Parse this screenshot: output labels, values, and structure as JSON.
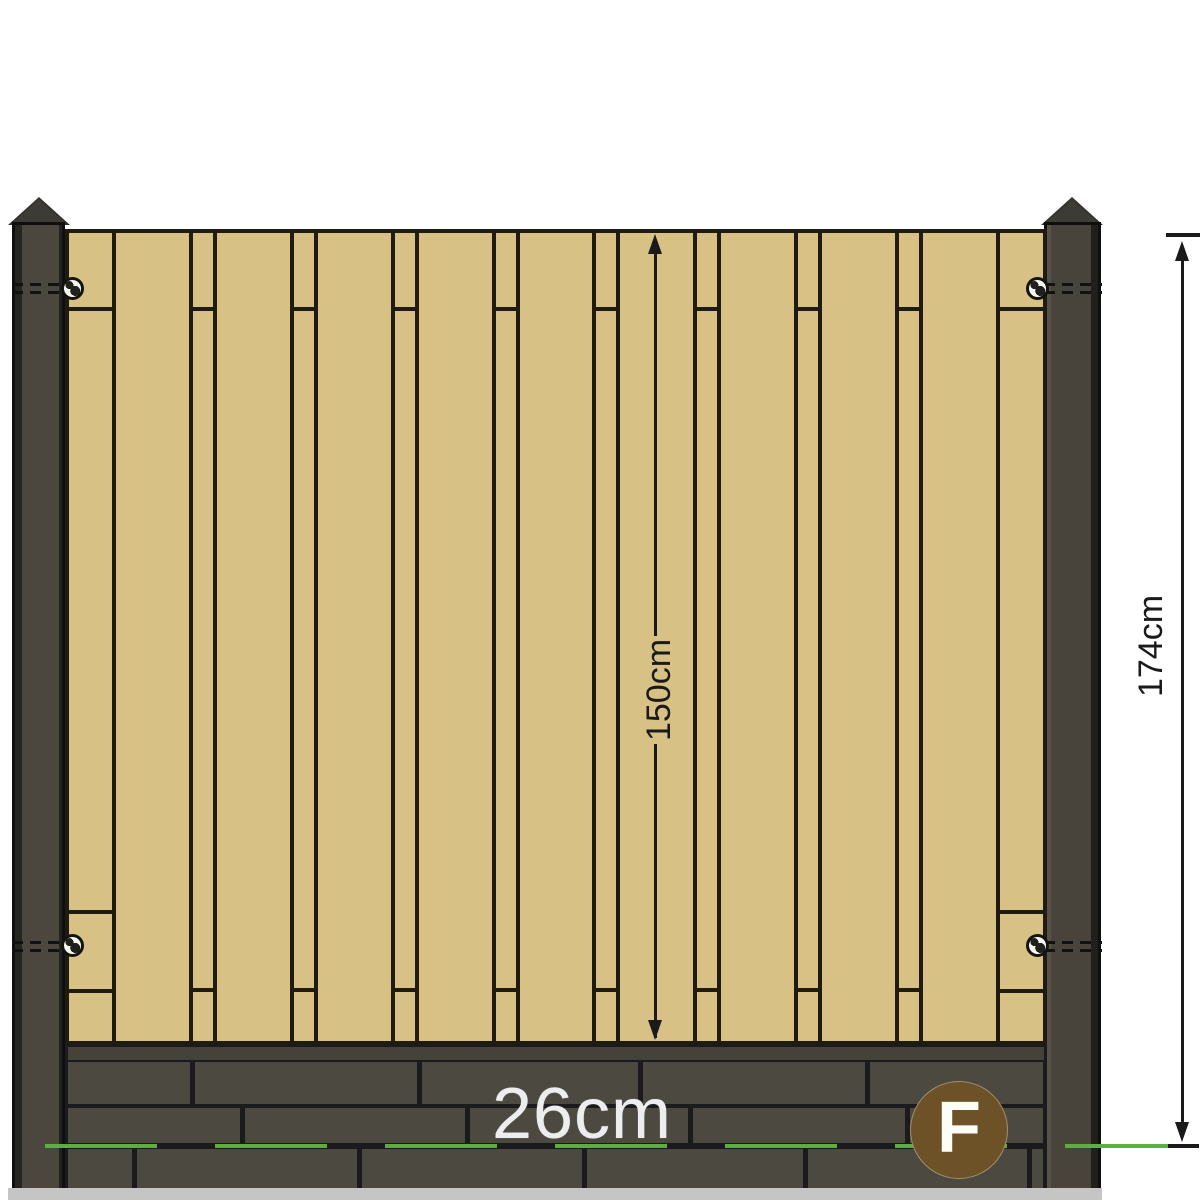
{
  "title": "Fence panel dimension diagram",
  "labels": {
    "panel_height": "150cm",
    "total_height": "174cm",
    "gravel_board_height": "26cm",
    "badge": "F"
  },
  "colors": {
    "bg": "#ffffff",
    "wood": "#d7c185",
    "wood_line": "#1f1b10",
    "post_body": "#4c473e",
    "brick": "#4b4940",
    "mortar": "#1b1b1e",
    "green": "#5fae3a",
    "badge": "#6e5227",
    "dim": "#1a1a1a",
    "label_light": "#ededed"
  },
  "panel": {
    "inner_left": 69,
    "inner_right": 1043,
    "inner_top": 233,
    "inner_bottom": 1041,
    "edge_board_width": 43,
    "narrow_board_width": 20,
    "gap_width": 4,
    "wide_board_count": 9,
    "edge_seams_y": [
      307,
      910,
      989
    ],
    "narrow_seams_y": [
      307,
      988
    ]
  },
  "gravel": {
    "left": 68,
    "right": 1043,
    "joint_gap": 5,
    "rows": [
      {
        "y": 1062,
        "h": 42,
        "joints": [
          190,
          417,
          638,
          865
        ]
      },
      {
        "y": 1108,
        "h": 35,
        "joints": [
          240,
          465,
          688,
          905
        ]
      },
      {
        "y": 1149,
        "h": 39,
        "joints": [
          132,
          357,
          582,
          803,
          1027
        ]
      }
    ]
  },
  "bolts": [
    {
      "x": 12,
      "w": 55,
      "y": 283
    },
    {
      "x": 12,
      "w": 55,
      "y": 291
    },
    {
      "x": 12,
      "w": 55,
      "y": 941
    },
    {
      "x": 12,
      "w": 55,
      "y": 949
    },
    {
      "x": 1044,
      "w": 58,
      "y": 283
    },
    {
      "x": 1044,
      "w": 58,
      "y": 291
    },
    {
      "x": 1044,
      "w": 58,
      "y": 941
    },
    {
      "x": 1044,
      "w": 58,
      "y": 949
    }
  ],
  "screws": [
    {
      "cx": 72,
      "cy": 288
    },
    {
      "cx": 72,
      "cy": 945
    },
    {
      "cx": 1037,
      "cy": 288
    },
    {
      "cx": 1037,
      "cy": 945
    }
  ]
}
